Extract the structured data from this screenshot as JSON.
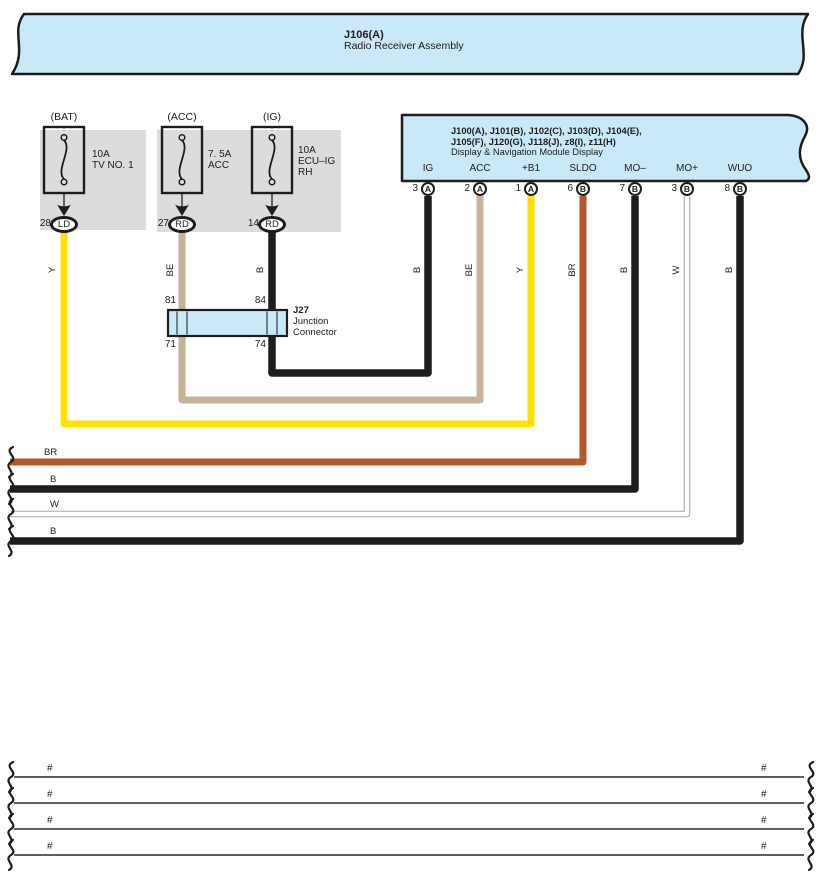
{
  "colors": {
    "line": "#1d1d1b",
    "panel_blue": "#c9e8f8",
    "panel_gray": "#dcdcdc",
    "wire": {
      "Y": "#ffe202",
      "BE": "#c7b299",
      "B": "#1d1d1b",
      "BR": "#b4572a",
      "W": "#ffffff",
      "W_edge": "#a8a8a8"
    }
  },
  "banner": {
    "code": "J106(A)",
    "name": "Radio Receiver Assembly"
  },
  "fuses": [
    {
      "id": "bat",
      "system": "(BAT)",
      "rating": "10A",
      "name_lines": [
        "TV NO. 1"
      ],
      "terminal": "28",
      "pin_label": "LD",
      "x": 64,
      "label_x": 92,
      "text_top": 149
    },
    {
      "id": "acc",
      "system": "(ACC)",
      "rating": "7. 5A",
      "name_lines": [
        "ACC"
      ],
      "terminal": "27",
      "pin_label": "RD",
      "x": 182,
      "label_x": 208,
      "text_top": 149
    },
    {
      "id": "ig",
      "system": "(IG)",
      "rating": "10A",
      "name_lines": [
        "ECU–IG",
        "RH"
      ],
      "terminal": "14",
      "pin_label": "RD",
      "x": 272,
      "label_x": 298,
      "text_top": 145
    }
  ],
  "module": {
    "title_line1": "J100(A), J101(B), J102(C), J103(D), J104(E),",
    "title_line2": "J105(F), J120(G), J118(J), z8(I), z11(H)",
    "subtitle": "Display & Navigation Module Display",
    "pins": [
      {
        "name": "IG",
        "terminal": "3",
        "connector": "A",
        "x": 428
      },
      {
        "name": "ACC",
        "terminal": "2",
        "connector": "A",
        "x": 480
      },
      {
        "name": "+B1",
        "terminal": "1",
        "connector": "A",
        "x": 531
      },
      {
        "name": "SLDO",
        "terminal": "6",
        "connector": "B",
        "x": 583
      },
      {
        "name": "MO–",
        "terminal": "7",
        "connector": "B",
        "x": 635
      },
      {
        "name": "MO+",
        "terminal": "3",
        "connector": "B",
        "x": 687
      },
      {
        "name": "WUO",
        "terminal": "8",
        "connector": "B",
        "x": 740
      }
    ]
  },
  "junction_connector": {
    "code": "J27",
    "name_line1": "Junction",
    "name_line2": "Connector",
    "pin_top_left": "81",
    "pin_top_right": "84",
    "pin_bottom_left": "71",
    "pin_bottom_right": "74"
  },
  "wires": [
    {
      "code": "Y",
      "points": [
        [
          64,
          230
        ],
        [
          64,
          424
        ],
        [
          531,
          424
        ],
        [
          531,
          196
        ]
      ],
      "labels": [
        {
          "x": 53,
          "y": 270,
          "rot": true
        },
        {
          "x": 521,
          "y": 270,
          "rot": true
        }
      ]
    },
    {
      "code": "BE",
      "points": [
        [
          182,
          230
        ],
        [
          182,
          400
        ],
        [
          480,
          400
        ],
        [
          480,
          196
        ]
      ],
      "labels": [
        {
          "x": 171,
          "y": 270,
          "rot": true
        },
        {
          "x": 470,
          "y": 270,
          "rot": true
        }
      ]
    },
    {
      "code": "B",
      "points": [
        [
          272,
          230
        ],
        [
          272,
          373
        ],
        [
          428,
          373
        ],
        [
          428,
          196
        ]
      ],
      "labels": [
        {
          "x": 261,
          "y": 270,
          "rot": true
        },
        {
          "x": 418,
          "y": 270,
          "rot": true
        }
      ]
    },
    {
      "code": "BR",
      "points": [
        [
          583,
          196
        ],
        [
          583,
          462
        ],
        [
          10,
          462
        ]
      ],
      "labels": [
        {
          "x": 573,
          "y": 270,
          "rot": true
        },
        {
          "x": 44,
          "y": 448,
          "rot": false
        }
      ]
    },
    {
      "code": "B",
      "points": [
        [
          635,
          196
        ],
        [
          635,
          489
        ],
        [
          10,
          489
        ]
      ],
      "labels": [
        {
          "x": 625,
          "y": 270,
          "rot": true
        },
        {
          "x": 50,
          "y": 475,
          "rot": false
        }
      ]
    },
    {
      "code": "W",
      "points": [
        [
          687,
          196
        ],
        [
          687,
          514
        ],
        [
          10,
          514
        ]
      ],
      "labels": [
        {
          "x": 677,
          "y": 270,
          "rot": true
        },
        {
          "x": 50,
          "y": 500,
          "rot": false
        }
      ]
    },
    {
      "code": "B",
      "points": [
        [
          740,
          196
        ],
        [
          740,
          541
        ],
        [
          10,
          541
        ]
      ],
      "labels": [
        {
          "x": 730,
          "y": 270,
          "rot": true
        },
        {
          "x": 50,
          "y": 527,
          "rot": false
        }
      ]
    }
  ],
  "bottom_rows": [
    {
      "left": "#",
      "right": "#",
      "y": 777
    },
    {
      "left": "#",
      "right": "#",
      "y": 803
    },
    {
      "left": "#",
      "right": "#",
      "y": 829
    },
    {
      "left": "#",
      "right": "#",
      "y": 855
    }
  ]
}
